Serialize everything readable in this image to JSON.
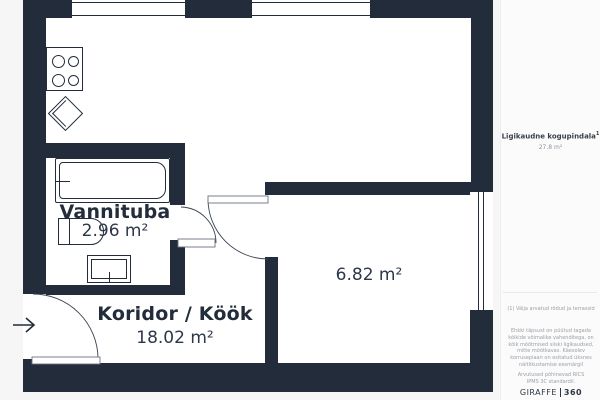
{
  "colors": {
    "wall": "#232c3a",
    "room": "#ffffff",
    "page_background": "#f6f6f7",
    "muted_text": "#9aa0a6"
  },
  "floorplan": {
    "rooms": [
      {
        "name": "Vannituba",
        "area": "2.96 m²"
      },
      {
        "name": "Koridor / Köök",
        "area": "18.02 m²"
      },
      {
        "name": "",
        "area": "6.82 m²"
      }
    ],
    "icons": {
      "entry_arrow": "arrow-right",
      "fixtures": [
        "stove",
        "sink",
        "bathtub",
        "toilet",
        "washbasin"
      ]
    }
  },
  "sidebar": {
    "total_label": "Ligikaudne kogupindala",
    "total_marker": "1",
    "total_value": "27.8 m²",
    "footnote": "(1) Välja arvatud rõdud ja terrassid",
    "disclaimer": "Ehkki täpsust on püütud tagada kõikide võimalike vahenditega, on kõik mõõtmised siiski ligikaudsed, mitte mõõtkavas. Käesolev korruseplaan on esitatud üksnes näitlikustamise eesmärgil",
    "standard": "Arvutused põhinevad RICS IPMS 3C standardil.",
    "logo_primary": "GIRAFFE",
    "logo_secondary": "360"
  }
}
